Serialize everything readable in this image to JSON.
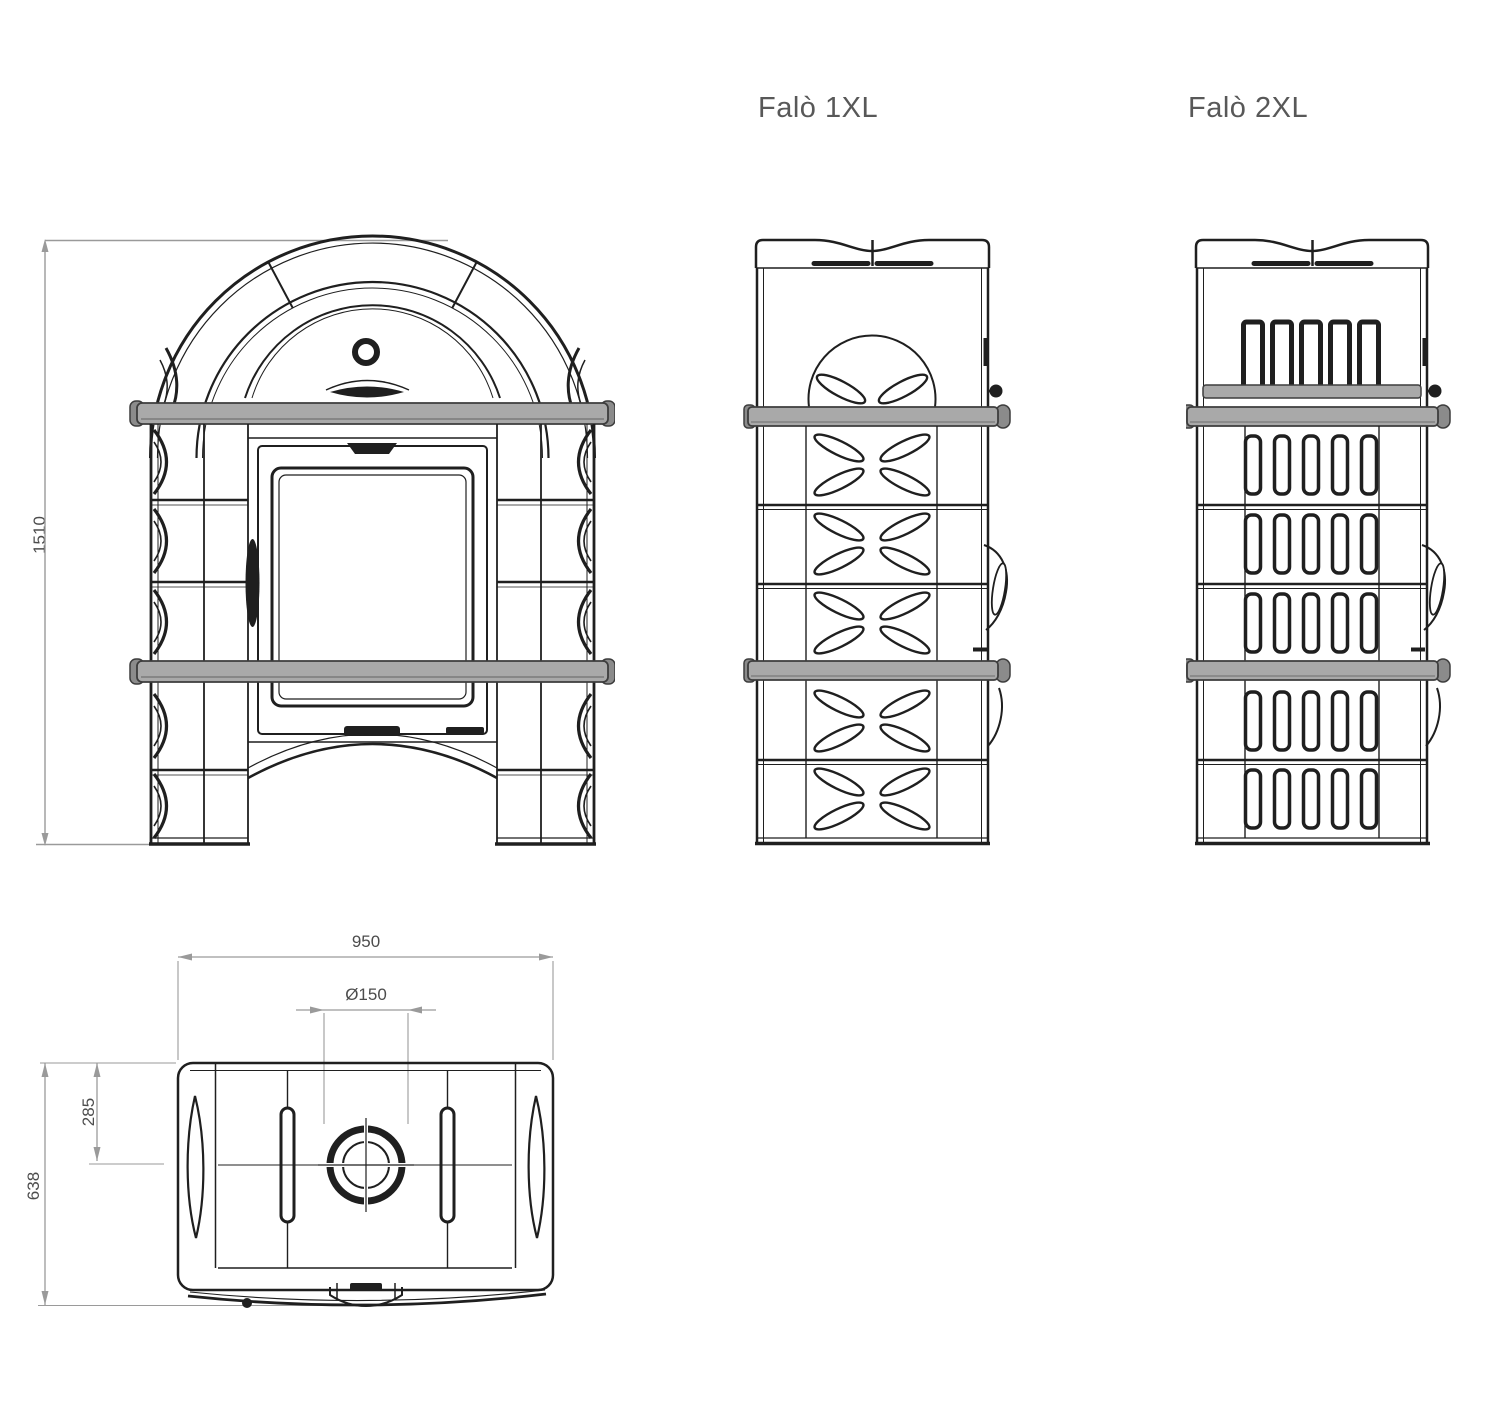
{
  "colors": {
    "background": "#ffffff",
    "line": "#1f1f1f",
    "band_fill": "#a9a9a9",
    "band_cap": "#8b8b8b",
    "band_stroke": "#3d3d3d",
    "dim_line": "#9a9a9a",
    "dim_text": "#4c4c4c",
    "title_text": "#585858"
  },
  "labels": {
    "model_1xl": "Falò 1XL",
    "model_2xl": "Falò 2XL"
  },
  "dimensions": {
    "overall_height": "1510",
    "overall_width": "950",
    "flue_diameter": "Ø150",
    "flue_center_offset": "285",
    "overall_depth": "638"
  }
}
